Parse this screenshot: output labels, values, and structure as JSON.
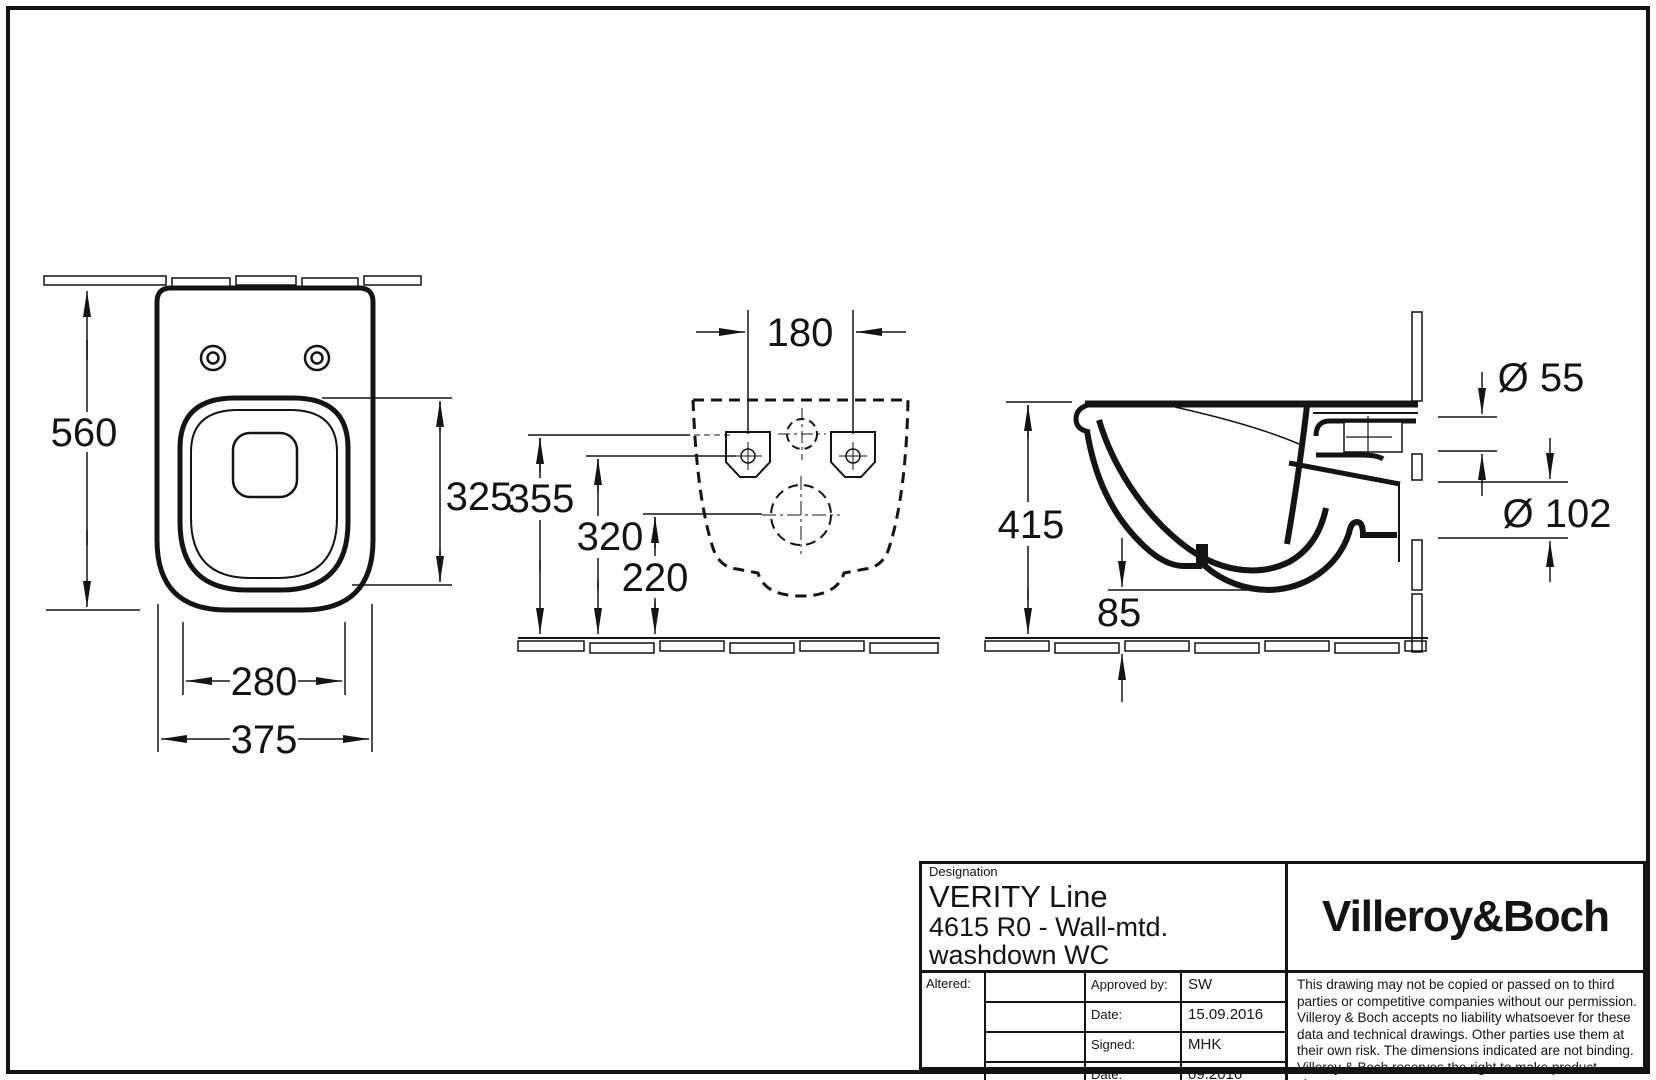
{
  "views": {
    "top": {
      "title": "top-view",
      "dims": {
        "depth": "560",
        "inner_length": "325",
        "inner_width": "280",
        "width": "375"
      }
    },
    "rear": {
      "title": "rear-installation-view",
      "dims": {
        "hole_spacing": "180",
        "supply_height": "355",
        "fixing_height": "320",
        "outlet_height": "220"
      }
    },
    "side": {
      "title": "side-section-view",
      "dims": {
        "rim_height": "415",
        "bottom_clearance": "85",
        "supply_dia": "Ø 55",
        "outlet_dia": "Ø 102"
      }
    }
  },
  "title_block": {
    "designation_label": "Designation",
    "series": "VERITY Line",
    "model": "4615 R0 - Wall-mtd. washdown WC",
    "brand": "Villeroy&Boch",
    "altered_label": "Altered:",
    "rows": [
      {
        "label": "Approved by:",
        "value": "SW"
      },
      {
        "label": "Date:",
        "value": "15.09.2016"
      },
      {
        "label": "Signed:",
        "value": "MHK"
      },
      {
        "label": "Date:",
        "value": "09.2016"
      }
    ],
    "disclaimer": "This drawing may not be copied or passed on to third parties or competitive companies without our permission. Villeroy & Boch accepts no liability whatsoever for these data and technical drawings. Other parties use them at their own risk. The dimensions indicated are not binding. Villeroy & Boch reserves the right to make product changes."
  },
  "colors": {
    "line": "#141414",
    "background": "#ffffff"
  }
}
